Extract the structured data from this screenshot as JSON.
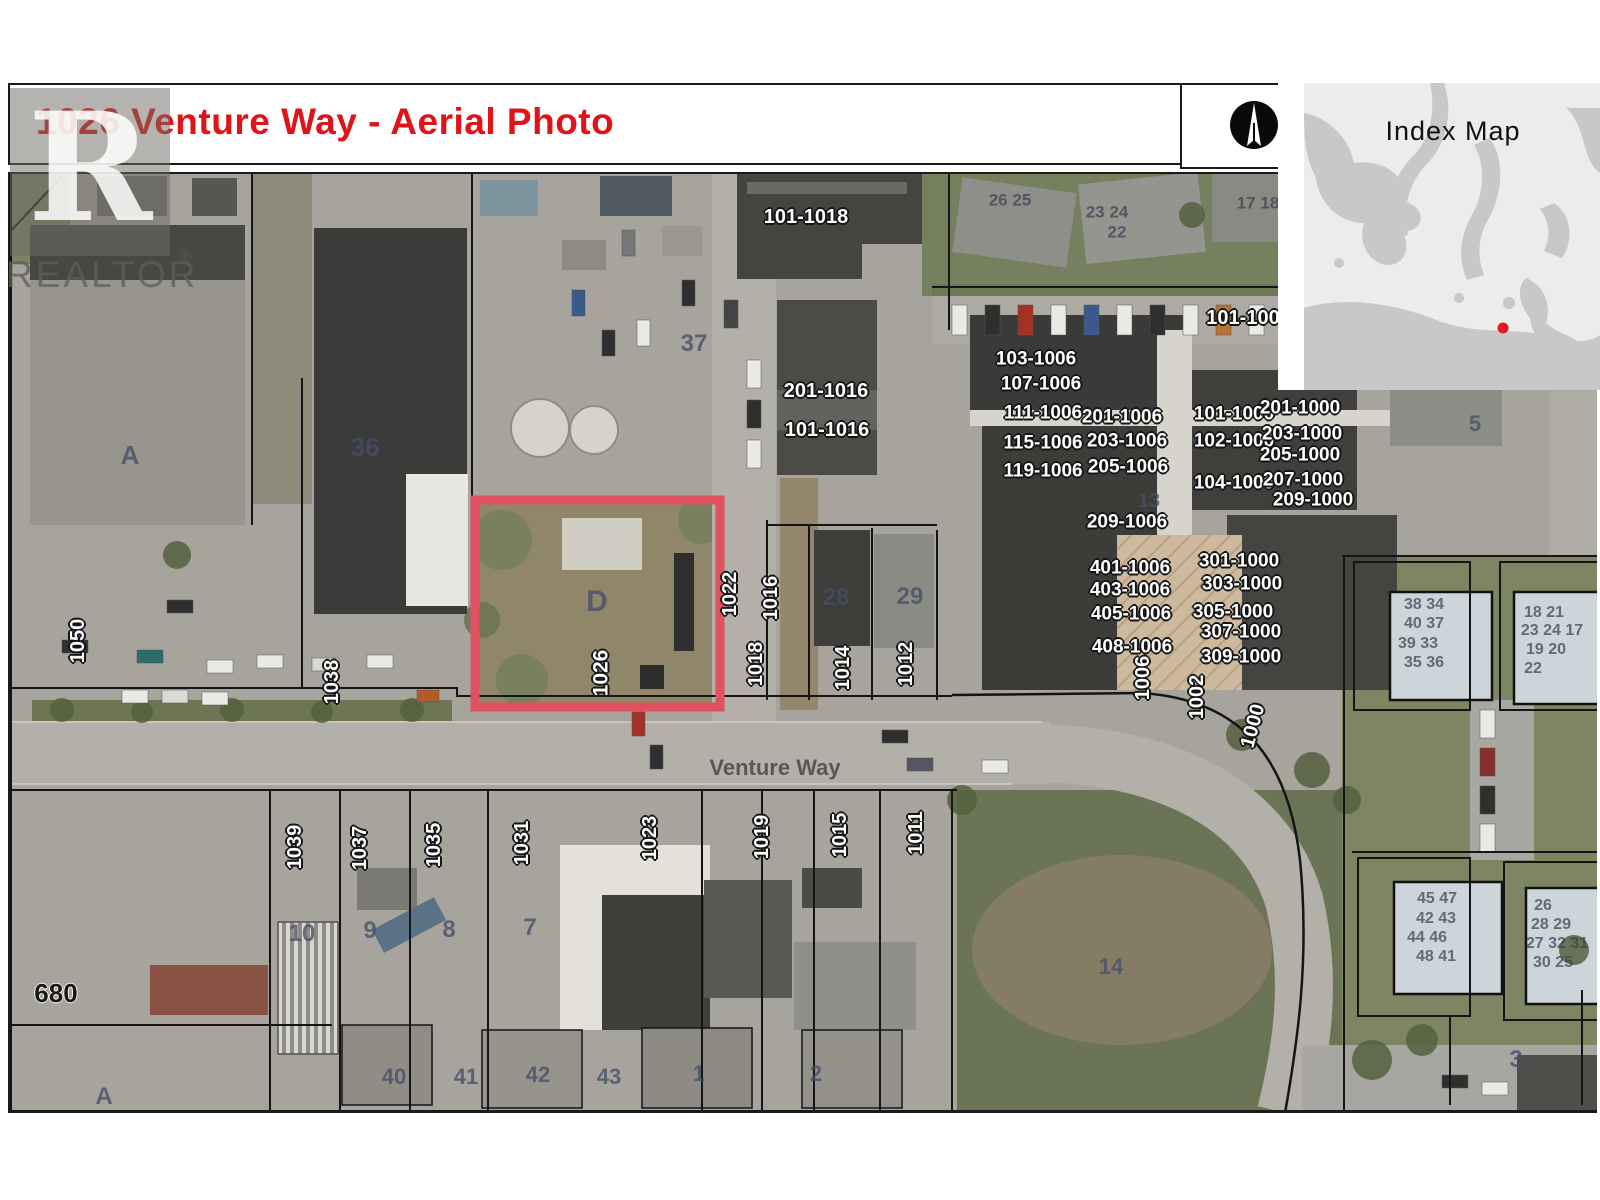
{
  "title": {
    "text": "1026 Venture Way - Aerial Photo"
  },
  "watermark": {
    "text": "REALTOR",
    "reg": "®"
  },
  "index_map": {
    "title": "Index Map",
    "dot_color": "#e01b1b"
  },
  "colors": {
    "highlight": "#df5360",
    "parcel_line": "#151515"
  },
  "map": {
    "street_name": "Venture Way",
    "subject_parcel": "1026",
    "labels": [
      {
        "t": "101-1018",
        "x": 806,
        "y": 217,
        "c": "halo",
        "s": 20
      },
      {
        "t": "201-1016",
        "x": 826,
        "y": 391,
        "c": "halo",
        "s": 20
      },
      {
        "t": "101-1016",
        "x": 827,
        "y": 430,
        "c": "halo",
        "s": 20
      },
      {
        "t": "103-1006",
        "x": 1036,
        "y": 359,
        "c": "halo",
        "s": 19
      },
      {
        "t": "107-1006",
        "x": 1041,
        "y": 384,
        "c": "halo",
        "s": 19
      },
      {
        "t": "111-1006",
        "x": 1043,
        "y": 413,
        "c": "halo",
        "s": 19
      },
      {
        "t": "201-1006",
        "x": 1122,
        "y": 417,
        "c": "halo",
        "s": 19
      },
      {
        "t": "115-1006",
        "x": 1043,
        "y": 443,
        "c": "halo",
        "s": 19
      },
      {
        "t": "203-1006",
        "x": 1127,
        "y": 441,
        "c": "halo",
        "s": 19
      },
      {
        "t": "205-1006",
        "x": 1128,
        "y": 467,
        "c": "halo",
        "s": 19
      },
      {
        "t": "119-1006",
        "x": 1043,
        "y": 471,
        "c": "halo",
        "s": 19
      },
      {
        "t": "209-1006",
        "x": 1127,
        "y": 522,
        "c": "halo",
        "s": 19
      },
      {
        "t": "101-1000",
        "x": 1234,
        "y": 414,
        "c": "halo",
        "s": 19
      },
      {
        "t": "102-1000",
        "x": 1234,
        "y": 441,
        "c": "halo",
        "s": 19
      },
      {
        "t": "104-1000",
        "x": 1234,
        "y": 483,
        "c": "halo",
        "s": 19
      },
      {
        "t": "201-1000",
        "x": 1300,
        "y": 408,
        "c": "halo",
        "s": 19
      },
      {
        "t": "203-1000",
        "x": 1302,
        "y": 434,
        "c": "halo",
        "s": 19
      },
      {
        "t": "205-1000",
        "x": 1300,
        "y": 455,
        "c": "halo",
        "s": 19
      },
      {
        "t": "207-1000",
        "x": 1303,
        "y": 480,
        "c": "halo",
        "s": 19
      },
      {
        "t": "209-1000",
        "x": 1313,
        "y": 500,
        "c": "halo",
        "s": 19
      },
      {
        "t": "301-1000",
        "x": 1239,
        "y": 561,
        "c": "halo",
        "s": 19
      },
      {
        "t": "303-1000",
        "x": 1242,
        "y": 584,
        "c": "halo",
        "s": 19
      },
      {
        "t": "305-1000",
        "x": 1233,
        "y": 612,
        "c": "halo",
        "s": 19
      },
      {
        "t": "307-1000",
        "x": 1241,
        "y": 632,
        "c": "halo",
        "s": 19
      },
      {
        "t": "309-1000",
        "x": 1241,
        "y": 657,
        "c": "halo",
        "s": 19
      },
      {
        "t": "401-1006",
        "x": 1130,
        "y": 568,
        "c": "halo",
        "s": 19
      },
      {
        "t": "403-1006",
        "x": 1130,
        "y": 590,
        "c": "halo",
        "s": 19
      },
      {
        "t": "405-1006",
        "x": 1131,
        "y": 614,
        "c": "halo",
        "s": 19
      },
      {
        "t": "408-1006",
        "x": 1132,
        "y": 647,
        "c": "halo",
        "s": 19
      },
      {
        "t": "101-100",
        "x": 1243,
        "y": 318,
        "c": "halo",
        "s": 20
      },
      {
        "t": "1050",
        "x": 78,
        "y": 641,
        "r": -90,
        "c": "halo",
        "s": 20
      },
      {
        "t": "1038",
        "x": 332,
        "y": 682,
        "r": -90,
        "c": "halo",
        "s": 20
      },
      {
        "t": "1026",
        "x": 601,
        "y": 673,
        "r": -90,
        "c": "halo",
        "s": 21
      },
      {
        "t": "1022",
        "x": 730,
        "y": 594,
        "r": -90,
        "c": "halo",
        "s": 20
      },
      {
        "t": "1016",
        "x": 771,
        "y": 598,
        "r": -90,
        "c": "halo",
        "s": 20
      },
      {
        "t": "1018",
        "x": 756,
        "y": 664,
        "r": -90,
        "c": "halo",
        "s": 20
      },
      {
        "t": "1014",
        "x": 843,
        "y": 668,
        "r": -90,
        "c": "halo",
        "s": 20
      },
      {
        "t": "1012",
        "x": 906,
        "y": 664,
        "r": -90,
        "c": "halo",
        "s": 20
      },
      {
        "t": "1006",
        "x": 1143,
        "y": 678,
        "r": -90,
        "c": "halo",
        "s": 20
      },
      {
        "t": "1002",
        "x": 1197,
        "y": 697,
        "r": -90,
        "c": "halo",
        "s": 20
      },
      {
        "t": "1000",
        "x": 1253,
        "y": 726,
        "r": -75,
        "c": "halo",
        "s": 20
      },
      {
        "t": "1039",
        "x": 295,
        "y": 847,
        "r": -90,
        "c": "halo",
        "s": 20
      },
      {
        "t": "1037",
        "x": 360,
        "y": 848,
        "r": -90,
        "c": "halo",
        "s": 20
      },
      {
        "t": "1035",
        "x": 434,
        "y": 845,
        "r": -90,
        "c": "halo",
        "s": 20
      },
      {
        "t": "1031",
        "x": 522,
        "y": 843,
        "r": -90,
        "c": "halo",
        "s": 20
      },
      {
        "t": "1023",
        "x": 650,
        "y": 838,
        "r": -90,
        "c": "halo",
        "s": 20
      },
      {
        "t": "1019",
        "x": 762,
        "y": 837,
        "r": -90,
        "c": "halo",
        "s": 20
      },
      {
        "t": "1015",
        "x": 840,
        "y": 835,
        "r": -90,
        "c": "halo",
        "s": 20
      },
      {
        "t": "1011",
        "x": 916,
        "y": 833,
        "r": -90,
        "c": "halo",
        "s": 20
      },
      {
        "t": "A",
        "x": 130,
        "y": 455,
        "c": "plain",
        "s": 26
      },
      {
        "t": "36",
        "x": 365,
        "y": 447,
        "c": "plain",
        "s": 26
      },
      {
        "t": "37",
        "x": 694,
        "y": 344,
        "c": "plain",
        "s": 24
      },
      {
        "t": "28",
        "x": 836,
        "y": 598,
        "c": "plain",
        "s": 24
      },
      {
        "t": "29",
        "x": 910,
        "y": 597,
        "c": "plain",
        "s": 24
      },
      {
        "t": "13",
        "x": 1149,
        "y": 501,
        "c": "plain",
        "s": 20
      },
      {
        "t": "D",
        "x": 597,
        "y": 602,
        "c": "plain",
        "s": 30
      },
      {
        "t": "Venture Way",
        "x": 775,
        "y": 768,
        "c": "street",
        "s": 22
      },
      {
        "t": "10",
        "x": 302,
        "y": 934,
        "c": "plain",
        "s": 24
      },
      {
        "t": "9",
        "x": 370,
        "y": 931,
        "c": "plain",
        "s": 24
      },
      {
        "t": "8",
        "x": 449,
        "y": 930,
        "c": "plain",
        "s": 24
      },
      {
        "t": "7",
        "x": 530,
        "y": 928,
        "c": "plain",
        "s": 24
      },
      {
        "t": "14",
        "x": 1111,
        "y": 967,
        "c": "plain",
        "s": 22
      },
      {
        "t": "5",
        "x": 1475,
        "y": 424,
        "c": "plain",
        "s": 22
      },
      {
        "t": "3",
        "x": 1516,
        "y": 1060,
        "c": "plain",
        "s": 24
      },
      {
        "t": "680",
        "x": 56,
        "y": 993,
        "c": "halo-dark",
        "s": 26
      },
      {
        "t": "A",
        "x": 104,
        "y": 1097,
        "c": "plain",
        "s": 24
      },
      {
        "t": "40",
        "x": 394,
        "y": 1077,
        "c": "plain",
        "s": 22
      },
      {
        "t": "41",
        "x": 466,
        "y": 1077,
        "c": "plain",
        "s": 22
      },
      {
        "t": "42",
        "x": 538,
        "y": 1075,
        "c": "plain",
        "s": 22
      },
      {
        "t": "43",
        "x": 609,
        "y": 1077,
        "c": "plain",
        "s": 22
      },
      {
        "t": "1",
        "x": 699,
        "y": 1074,
        "c": "plain",
        "s": 22
      },
      {
        "t": "2",
        "x": 816,
        "y": 1074,
        "c": "plain",
        "s": 22
      },
      {
        "t": "26 25",
        "x": 1010,
        "y": 200,
        "c": "faint",
        "s": 17
      },
      {
        "t": "23 24",
        "x": 1107,
        "y": 212,
        "c": "faint",
        "s": 17
      },
      {
        "t": "22",
        "x": 1117,
        "y": 232,
        "c": "faint",
        "s": 17
      },
      {
        "t": "17 18",
        "x": 1258,
        "y": 203,
        "c": "faint",
        "s": 17
      },
      {
        "t": "38 34",
        "x": 1424,
        "y": 605,
        "c": "faint",
        "s": 16
      },
      {
        "t": "40 37",
        "x": 1424,
        "y": 624,
        "c": "faint",
        "s": 16
      },
      {
        "t": "39 33",
        "x": 1418,
        "y": 644,
        "c": "faint",
        "s": 16
      },
      {
        "t": "35 36",
        "x": 1424,
        "y": 663,
        "c": "faint",
        "s": 16
      },
      {
        "t": "18 21",
        "x": 1544,
        "y": 613,
        "c": "faint",
        "s": 16
      },
      {
        "t": "23 24 17",
        "x": 1552,
        "y": 631,
        "c": "faint",
        "s": 16
      },
      {
        "t": "19 20",
        "x": 1546,
        "y": 650,
        "c": "faint",
        "s": 16
      },
      {
        "t": "22",
        "x": 1533,
        "y": 669,
        "c": "faint",
        "s": 16
      },
      {
        "t": "45 47",
        "x": 1437,
        "y": 899,
        "c": "faint",
        "s": 16
      },
      {
        "t": "42 43",
        "x": 1436,
        "y": 919,
        "c": "faint",
        "s": 16
      },
      {
        "t": "44 46",
        "x": 1427,
        "y": 938,
        "c": "faint",
        "s": 16
      },
      {
        "t": "48 41",
        "x": 1436,
        "y": 957,
        "c": "faint",
        "s": 16
      },
      {
        "t": "26",
        "x": 1543,
        "y": 906,
        "c": "faint",
        "s": 16
      },
      {
        "t": "28 29",
        "x": 1551,
        "y": 925,
        "c": "faint",
        "s": 16
      },
      {
        "t": "27 32 31",
        "x": 1557,
        "y": 944,
        "c": "faint",
        "s": 16
      },
      {
        "t": "30 25",
        "x": 1553,
        "y": 963,
        "c": "faint",
        "s": 16
      }
    ]
  }
}
